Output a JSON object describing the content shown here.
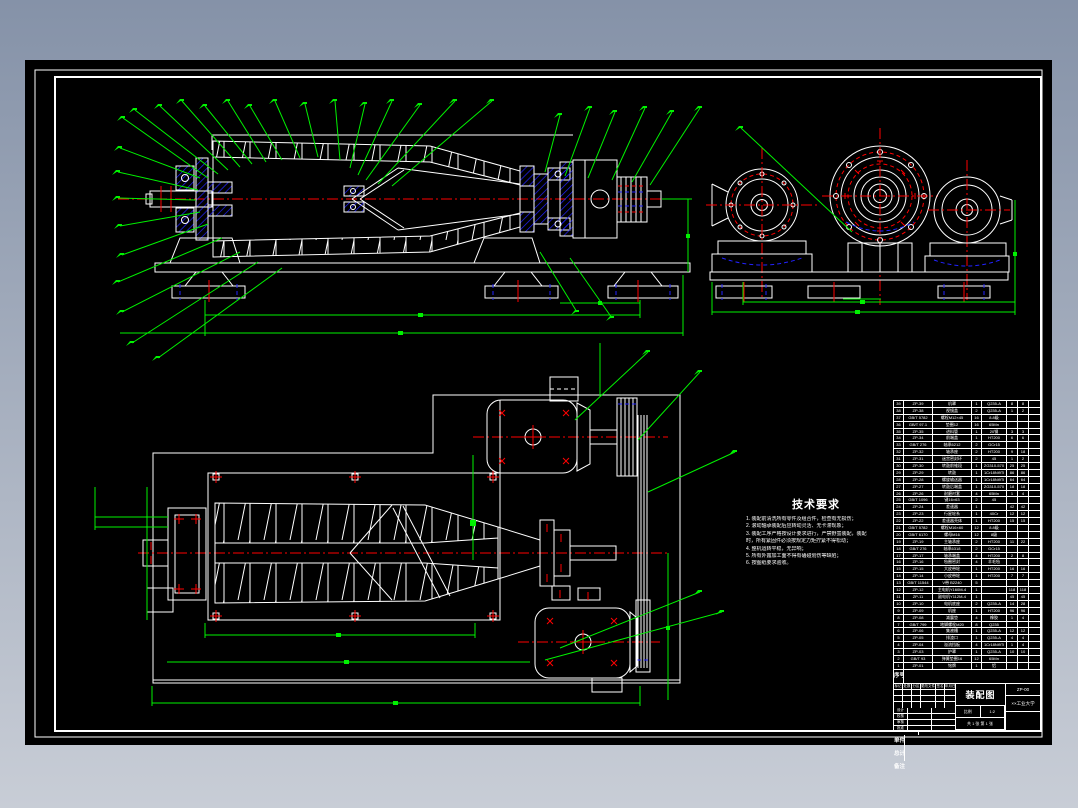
{
  "colors": {
    "background_top": "#8592a8",
    "background_bottom": "#c8cdd6",
    "sheet": "#000000",
    "line_white": "#ffffff",
    "line_green": "#00f200",
    "line_red": "#ff0000",
    "line_blue": "#2222ff"
  },
  "tech_requirements": {
    "title": "技术要求",
    "lines": [
      "1. 装配前清洗所有零件及组合件，检查有无损伤；",
      "2. 滚动轴承装配后应转动灵活、无卡滞现象；",
      "3. 装配工序严格按设计要求进行，严禁野蛮装配，装配",
      "    时，所有紧固件必须按规定力矩拧紧不得松动；",
      "4. 整机运转平稳，无异响；",
      "5. 所有外露加工面不得有磕碰划伤等缺陷；",
      "6. 按图纸要求验收。"
    ]
  },
  "bom": {
    "header": [
      "序号",
      "代号",
      "名称",
      "数量",
      "材料",
      "单件",
      "总计",
      "备注"
    ],
    "rows": [
      [
        "39",
        "ZP-39",
        "机罩",
        "1",
        "Q235-A",
        "8",
        "8",
        ""
      ],
      [
        "38",
        "ZP-38",
        "视镜盖",
        "2",
        "Q235-A",
        "1",
        "2",
        ""
      ],
      [
        "37",
        "GB/T 5782",
        "螺栓M12×45",
        "16",
        "8.8级",
        "",
        "",
        ""
      ],
      [
        "36",
        "GB/T 97.1",
        "垫圈12",
        "16",
        "65Mn",
        "",
        "",
        ""
      ],
      [
        "35",
        "ZP-35",
        "进料管",
        "1",
        "20钢",
        "3",
        "3",
        ""
      ],
      [
        "34",
        "ZP-34",
        "前端盖",
        "1",
        "HT200",
        "6",
        "6",
        ""
      ],
      [
        "33",
        "GB/T 276",
        "轴承6212",
        "2",
        "GCr15",
        "",
        "",
        ""
      ],
      [
        "32",
        "ZP-32",
        "轴承座",
        "2",
        "HT200",
        "9",
        "18",
        ""
      ],
      [
        "31",
        "ZP-31",
        "迷宫密封环",
        "2",
        "45",
        "1",
        "2",
        ""
      ],
      [
        "30",
        "ZP-30",
        "转鼓前锥段",
        "1",
        "ZG310-570",
        "25",
        "25",
        ""
      ],
      [
        "29",
        "ZP-29",
        "转鼓",
        "1",
        "1Cr18Ni9Ti",
        "86",
        "86",
        ""
      ],
      [
        "28",
        "ZP-28",
        "螺旋输送器",
        "1",
        "1Cr18Ni9Ti",
        "64",
        "64",
        ""
      ],
      [
        "27",
        "ZP-27",
        "转鼓后端盖",
        "1",
        "ZG310-570",
        "18",
        "18",
        ""
      ],
      [
        "26",
        "ZP-26",
        "耐磨衬套",
        "4",
        "65Mn",
        "1",
        "4",
        ""
      ],
      [
        "25",
        "GB/T 1096",
        "键16×63",
        "2",
        "45",
        "",
        "",
        ""
      ],
      [
        "24",
        "ZP-24",
        "差速器",
        "1",
        "",
        "42",
        "42",
        ""
      ],
      [
        "23",
        "ZP-23",
        "行星轮系",
        "1",
        "40Cr",
        "12",
        "12",
        ""
      ],
      [
        "22",
        "ZP-22",
        "差速器壳体",
        "1",
        "HT200",
        "15",
        "15",
        ""
      ],
      [
        "21",
        "GB/T 5782",
        "螺栓M16×60",
        "12",
        "8.8级",
        "",
        "",
        ""
      ],
      [
        "20",
        "GB/T 6170",
        "螺母M16",
        "12",
        "8级",
        "",
        "",
        ""
      ],
      [
        "19",
        "ZP-19",
        "主轴承座",
        "2",
        "HT200",
        "11",
        "22",
        ""
      ],
      [
        "18",
        "GB/T 276",
        "轴承6318",
        "2",
        "GCr15",
        "",
        "",
        ""
      ],
      [
        "17",
        "ZP-17",
        "轴承端盖",
        "4",
        "HT200",
        "2",
        "8",
        ""
      ],
      [
        "16",
        "ZP-16",
        "毡圈密封",
        "4",
        "羊毛毡",
        "",
        "",
        ""
      ],
      [
        "15",
        "ZP-15",
        "大皮带轮",
        "1",
        "HT200",
        "16",
        "16",
        ""
      ],
      [
        "14",
        "ZP-14",
        "小皮带轮",
        "1",
        "HT200",
        "7",
        "7",
        ""
      ],
      [
        "13",
        "GB/T 11544",
        "V带 B2240",
        "5",
        "",
        "",
        "",
        ""
      ],
      [
        "12",
        "ZP-12",
        "主电机Y160M-4",
        "1",
        "",
        "118",
        "118",
        ""
      ],
      [
        "11",
        "ZP-11",
        "副电机Y112M-4",
        "1",
        "",
        "45",
        "45",
        ""
      ],
      [
        "10",
        "ZP-10",
        "电机底座",
        "2",
        "Q235-A",
        "14",
        "28",
        ""
      ],
      [
        "9",
        "ZP-09",
        "机座",
        "1",
        "HT200",
        "96",
        "96",
        ""
      ],
      [
        "8",
        "ZP-08",
        "减震垫",
        "4",
        "橡胶",
        "1",
        "4",
        ""
      ],
      [
        "7",
        "GB/T 799",
        "地脚螺栓M20",
        "8",
        "Q235",
        "",
        "",
        ""
      ],
      [
        "6",
        "ZP-06",
        "集液槽",
        "1",
        "Q235-A",
        "12",
        "12",
        ""
      ],
      [
        "5",
        "ZP-05",
        "排渣口",
        "1",
        "Q235-A",
        "4",
        "4",
        ""
      ],
      [
        "4",
        "ZP-04",
        "溢流挡板",
        "4",
        "1Cr18Ni9Ti",
        "1",
        "4",
        ""
      ],
      [
        "3",
        "ZP-03",
        "护罩",
        "1",
        "Q235-A",
        "10",
        "10",
        ""
      ],
      [
        "2",
        "GB/T 93",
        "弹簧垫圈16",
        "12",
        "65Mn",
        "",
        "",
        ""
      ],
      [
        "1",
        "ZP-01",
        "铭牌",
        "1",
        "铝",
        "",
        "",
        ""
      ]
    ]
  },
  "title_block": {
    "title": "装配图",
    "org": "××工业大学",
    "code": "ZP-00",
    "change_rows": [
      [
        "标记",
        "处数",
        "分区",
        "更改文件号",
        "签名",
        "年月日"
      ],
      [
        "",
        "",
        "",
        "",
        "",
        ""
      ],
      [
        "",
        "",
        "",
        "",
        "",
        ""
      ],
      [
        "",
        "",
        "",
        "",
        "",
        ""
      ]
    ],
    "sig_rows": [
      [
        "设计",
        "",
        ""
      ],
      [
        "校核",
        "",
        ""
      ],
      [
        "审核",
        "",
        ""
      ],
      [
        "批准",
        "",
        ""
      ]
    ],
    "scale_label": "比例",
    "scale": "1:2",
    "qty_label": "数量",
    "qty": "1",
    "weight_label": "重量",
    "weight": "",
    "stage_label": "阶段标记",
    "sheets": "共 1 张  第 1 张"
  }
}
